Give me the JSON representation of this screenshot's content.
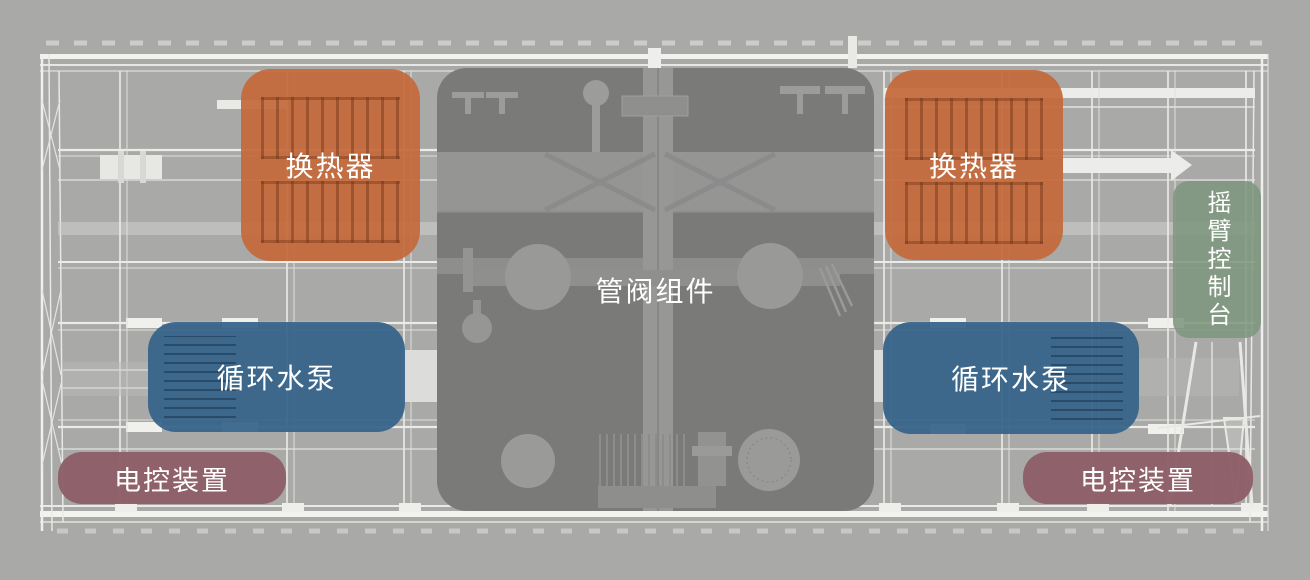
{
  "colors": {
    "background": "#a9a9a8",
    "frame_line": "#f0f0ed",
    "heat_exchanger": "#c5693a",
    "circulating_pump": "#36648a",
    "electric_control": "#8e5e67",
    "rocker_console": "#7d977d",
    "pipe_valve_assembly": "#7a7a79",
    "label_text": "#ffffff"
  },
  "components": {
    "heat_exchanger_left": {
      "label": "换热器"
    },
    "heat_exchanger_right": {
      "label": "换热器"
    },
    "pipe_valve_assembly": {
      "label": "管阀组件"
    },
    "circulating_pump_left": {
      "label": "循环水泵"
    },
    "circulating_pump_right": {
      "label": "循环水泵"
    },
    "electric_control_left": {
      "label": "电控装置"
    },
    "electric_control_right": {
      "label": "电控装置"
    },
    "rocker_arm_console": {
      "label": "摇臂控制台"
    }
  }
}
